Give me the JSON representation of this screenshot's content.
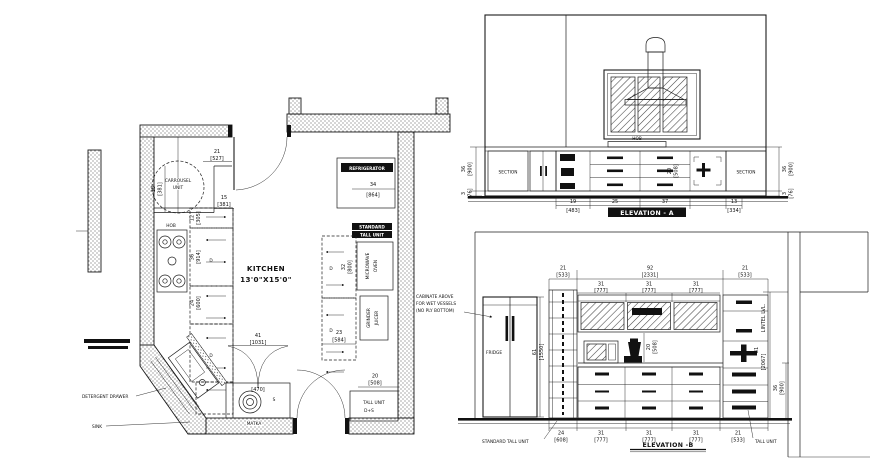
{
  "colors": {
    "paper": "#ffffff",
    "ink": "#1c1c1c"
  },
  "plan": {
    "title": "KITCHEN",
    "size": "13'0\"X15'0\"",
    "labels": {
      "carrousel1": "CARROUSEL",
      "carrousel2": "UNIT",
      "hob": "HOB",
      "refrigerator": "REFRIGERATOR",
      "std_tall1": "STANDARD",
      "std_tall2": "TALL UNIT",
      "micro1": "MICROWAVE",
      "micro2": "OVEN",
      "grinder1": "GRINDER",
      "grinder2": "JUICER",
      "tall_unit1": "TALL UNIT",
      "tall_unit2": "D+S",
      "matka": "MATKA",
      "s": "S",
      "d": "D",
      "detergent_drawer": "DETERGENT DRAWER",
      "sink": "SINK"
    },
    "dims": [
      {
        "v": "21",
        "mm": "[527]"
      },
      {
        "v": "15",
        "mm": "[381]"
      },
      {
        "v": "15",
        "mm": "[381]"
      },
      {
        "v": "12",
        "mm": "[305]"
      },
      {
        "v": "36",
        "mm": "[914]"
      },
      {
        "v": "24",
        "mm": "[600]"
      },
      {
        "v": "34",
        "mm": "[864]"
      },
      {
        "v": "32",
        "mm": "[800]"
      },
      {
        "v": "23",
        "mm": "[584]"
      },
      {
        "v": "20",
        "mm": "[508]"
      },
      {
        "v": "41",
        "mm": "[1031]"
      },
      {
        "v": "",
        "mm": "[470]"
      }
    ]
  },
  "elev_a": {
    "title": "ELEVATION - A",
    "section": "SECTION",
    "hob": "HOB",
    "dims": [
      {
        "v": "36",
        "mm": "[900]"
      },
      {
        "v": "3",
        "mm": "[76]"
      },
      {
        "v": "36",
        "mm": "[900]"
      },
      {
        "v": "3",
        "mm": "[76]"
      },
      {
        "v": "19",
        "mm": "[483]"
      },
      {
        "v": "25",
        "mm": "[635]"
      },
      {
        "v": "37",
        "mm": "[940]"
      },
      {
        "v": "13",
        "mm": "[334]"
      },
      {
        "v": "20",
        "mm": "[508]"
      }
    ]
  },
  "elev_b": {
    "title": "ELEVATION -B",
    "fridge": "FRIDGE",
    "standard_tall_unit": "STANDARD  TALL UNIT",
    "tall_unit": "TALL UNIT",
    "lintel": "LINTEL LVL.",
    "note1": "CABINATE ABOVE",
    "note2": "FOR WET VESSELS",
    "note3": "(NO PLY BOTTOM)",
    "dims": [
      {
        "v": "21",
        "mm": "[533]"
      },
      {
        "v": "92",
        "mm": "[2331]"
      },
      {
        "v": "21",
        "mm": "[533]"
      },
      {
        "v": "31",
        "mm": "[777]"
      },
      {
        "v": "31",
        "mm": "[777]"
      },
      {
        "v": "31",
        "mm": "[777]"
      },
      {
        "v": "61",
        "mm": "[1550]"
      },
      {
        "v": "81",
        "mm": "[2067]"
      },
      {
        "v": "36",
        "mm": "[900]"
      },
      {
        "v": "20",
        "mm": "[508]"
      },
      {
        "v": "24",
        "mm": "[608]"
      },
      {
        "v": "31",
        "mm": "[777]"
      },
      {
        "v": "31",
        "mm": "[777]"
      },
      {
        "v": "31",
        "mm": "[777]"
      },
      {
        "v": "21",
        "mm": "[533]"
      }
    ]
  }
}
